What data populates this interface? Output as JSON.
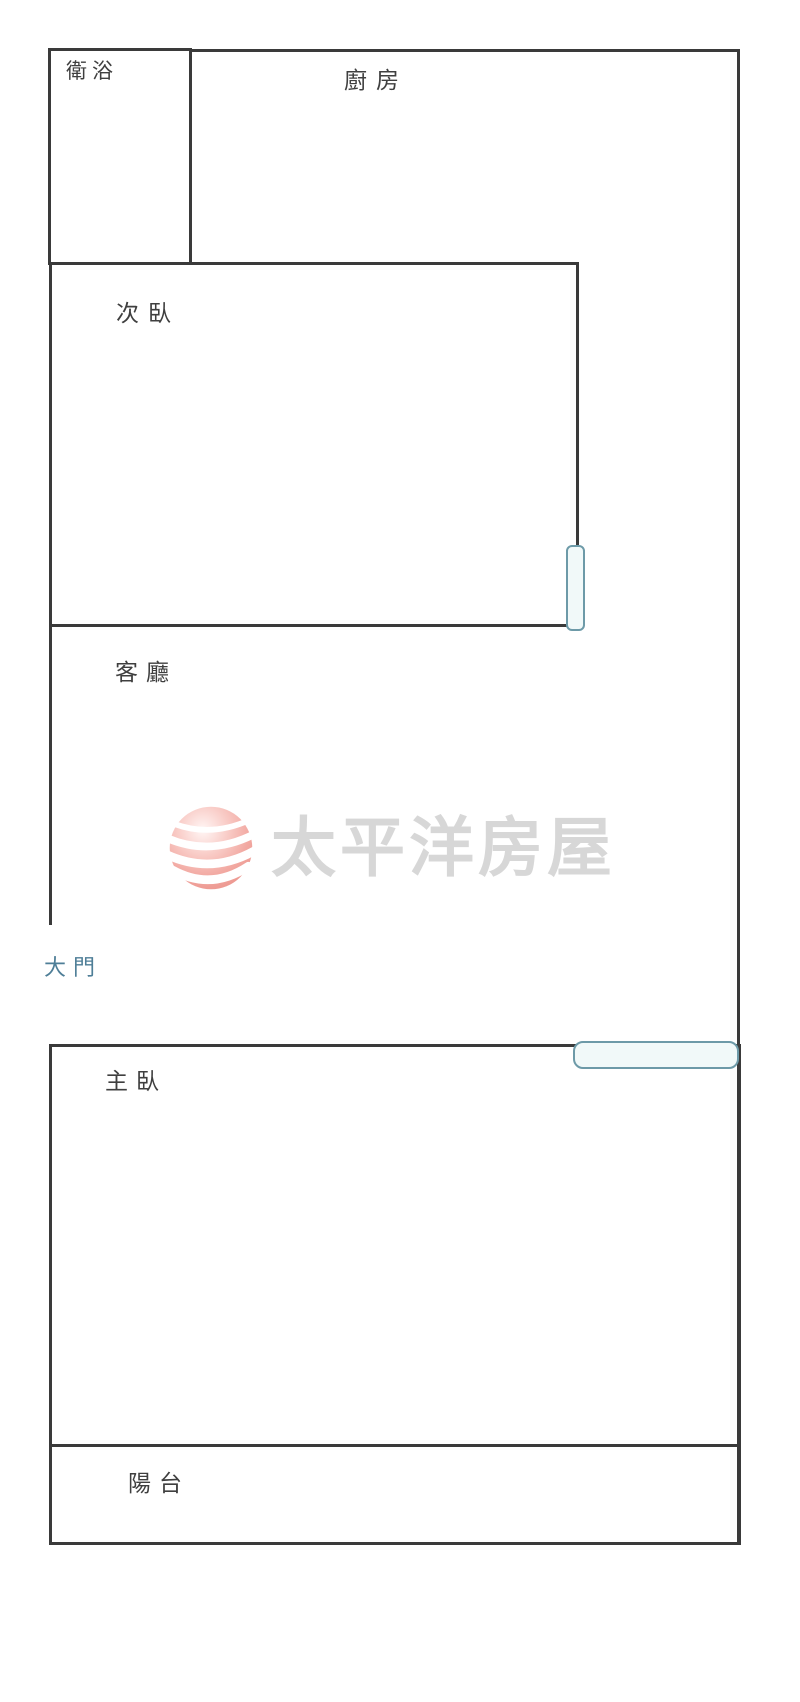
{
  "page": {
    "background_color": "#ffffff"
  },
  "plan": {
    "type": "floor-plan",
    "wall_color": "#3a3a3a",
    "label_color": "#3f3f3f",
    "door_window_border_color": "#6d9aa8",
    "door_window_fill_color": "#f1f9f9",
    "entrance_label_color": "#4e7e97",
    "rooms": {
      "bathroom": "衛浴",
      "kitchen": "廚房",
      "secondary_bedroom": "次臥",
      "living_room": "客廳",
      "entrance": "大門",
      "master_bedroom": "主臥",
      "balcony": "陽台"
    }
  },
  "watermark": {
    "brand_text": "太平洋房屋",
    "text_color": "#d7d7d7",
    "logo": {
      "name": "pacific-waves-sphere",
      "primary_color": "#f2a9a2",
      "highlight_color": "#fff6f5",
      "stripe_color": "#ffffff"
    }
  }
}
